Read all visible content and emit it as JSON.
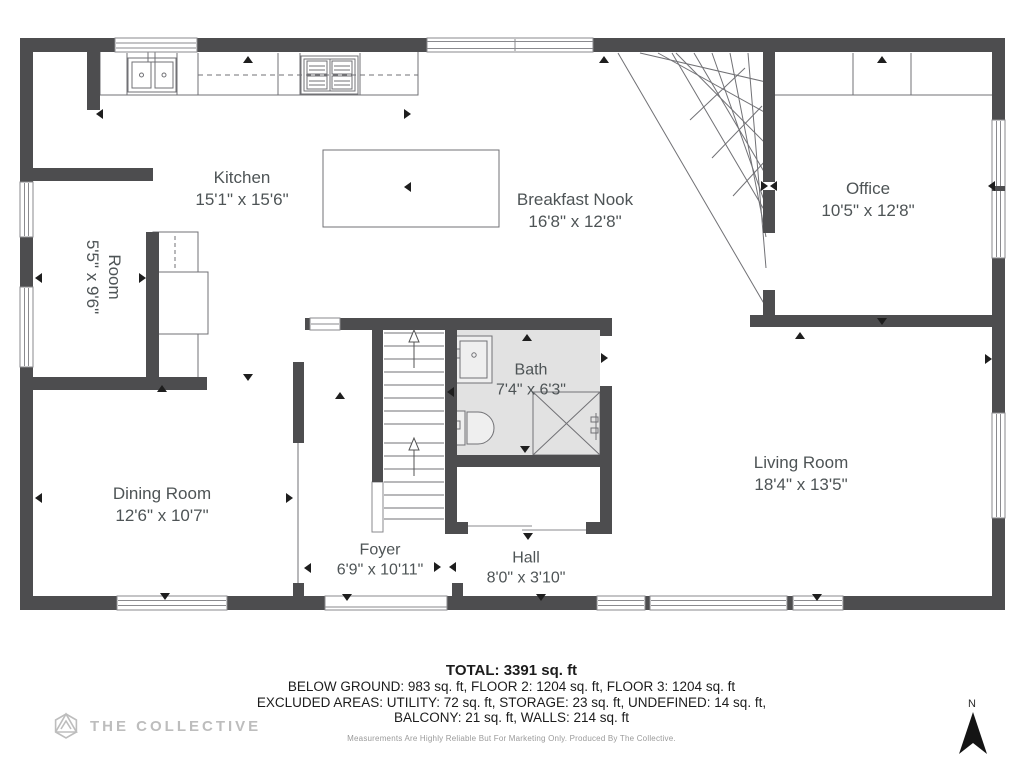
{
  "plan": {
    "rooms": [
      {
        "id": "kitchen",
        "name": "Kitchen",
        "dims": "15'1\" x 15'6\""
      },
      {
        "id": "breakfast-nook",
        "name": "Breakfast Nook",
        "dims": "16'8\" x 12'8\""
      },
      {
        "id": "office",
        "name": "Office",
        "dims": "10'5\" x 12'8\""
      },
      {
        "id": "room",
        "name": "Room",
        "dims": "5'5\" x 9'6\""
      },
      {
        "id": "bath",
        "name": "Bath",
        "dims": "7'4\" x 6'3\""
      },
      {
        "id": "dining-room",
        "name": "Dining Room",
        "dims": "12'6\" x 10'7\""
      },
      {
        "id": "living-room",
        "name": "Living Room",
        "dims": "18'4\" x 13'5\""
      },
      {
        "id": "foyer",
        "name": "Foyer",
        "dims": "6'9\" x 10'11\""
      },
      {
        "id": "hall",
        "name": "Hall",
        "dims": "8'0\" x 3'10\""
      }
    ]
  },
  "footer": {
    "total": "TOTAL: 3391 sq. ft",
    "line2": "BELOW GROUND: 983 sq. ft, FLOOR 2: 1204 sq. ft, FLOOR 3: 1204 sq. ft",
    "line3": "EXCLUDED AREAS: UTILITY: 72 sq. ft, STORAGE: 23 sq. ft, UNDEFINED: 14 sq. ft,",
    "line4": "BALCONY: 21 sq. ft, WALLS: 214 sq. ft",
    "disclaimer": "Measurements Are Highly Reliable But For Marketing Only. Produced By The Collective."
  },
  "branding": {
    "logo_text": "THE COLLECTIVE"
  },
  "compass": {
    "north_label": "N"
  },
  "colors": {
    "wall": "#4d4d4f",
    "bath_floor": "#e2e2e2",
    "thin_line": "#717175",
    "label_text": "#4e5456",
    "logo_gray": "#bdbdbd"
  }
}
